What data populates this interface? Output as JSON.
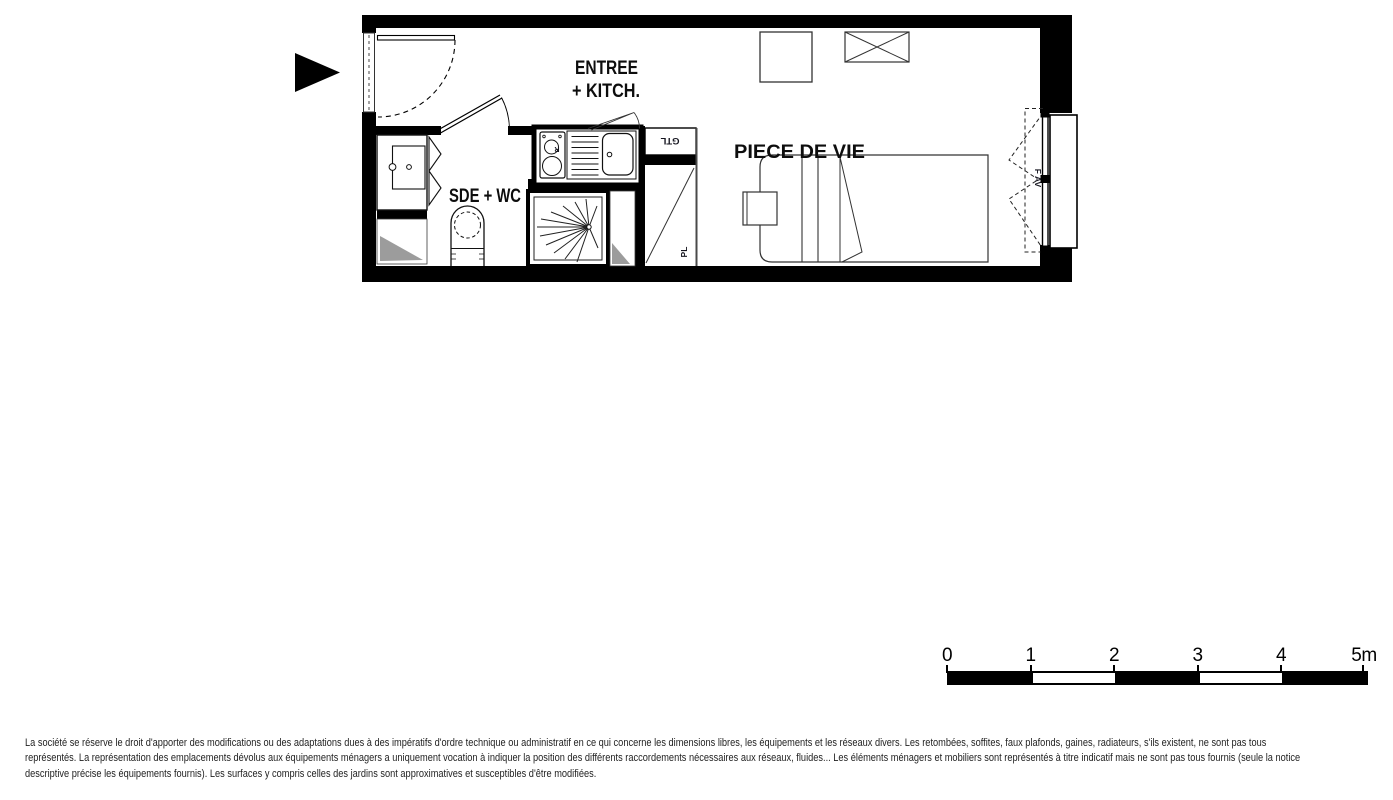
{
  "plan": {
    "rooms": {
      "entry_kitchen_line1": "ENTREE",
      "entry_kitchen_line2": "+ KITCH.",
      "bathroom": "SDE + WC",
      "living_room": "PIECE DE VIE"
    },
    "annotations": {
      "gtl": "GTL",
      "closet": "PL",
      "hob": "R",
      "window": "F AV"
    },
    "colors": {
      "wall": "#000000",
      "shaft_fill": "#9c9c9c"
    }
  },
  "scale_bar": {
    "unit_labels": [
      "0",
      "1",
      "2",
      "3",
      "4",
      "5m"
    ],
    "segment_colors": [
      "#000000",
      "#ffffff",
      "#000000",
      "#ffffff",
      "#000000"
    ]
  },
  "disclaimer": {
    "line1": "La société se réserve le droit d'apporter des modifications ou des adaptations dues à des impératifs d'ordre technique ou administratif en ce qui concerne les dimensions libres, les équipements et les réseaux divers. Les retombées, soffites, faux plafonds, gaines, radiateurs, s'ils existent, ne sont pas tous",
    "line2": "représentés. La représentation des emplacements dévolus aux équipements ménagers a uniquement vocation à indiquer la position des différents raccordements nécessaires aux réseaux, fluides... Les éléments ménagers et mobiliers sont représentés à titre indicatif mais ne sont pas tous fournis (seule la notice",
    "line3": "descriptive précise les équipements fournis). Les surfaces y compris celles des jardins sont approximatives et susceptibles d'être modifiées."
  }
}
